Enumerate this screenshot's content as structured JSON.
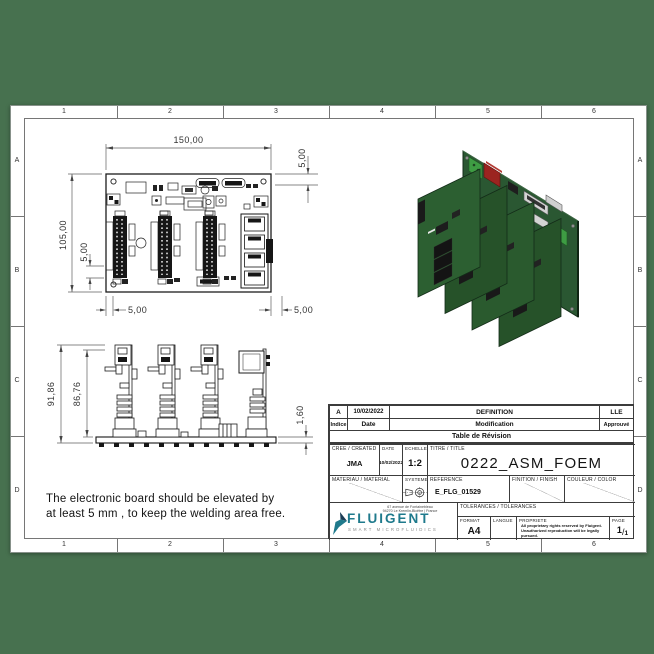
{
  "colors": {
    "background_green": "#47714F",
    "pcb_green": "#2A5732",
    "component_red": "#9B2420",
    "terminal_green": "#3E9C43",
    "logo_teal": "#1F7A8C",
    "logo_navy": "#1B3C55",
    "tagline_grey": "#8A8A8A"
  },
  "border": {
    "columns": [
      "1",
      "2",
      "3",
      "4",
      "5",
      "6"
    ],
    "rows": [
      "A",
      "B",
      "C",
      "D"
    ]
  },
  "views": {
    "top": {
      "width": "150,00",
      "height": "105,00",
      "margin_top": "5,00",
      "margin_left": "5,00",
      "margin_bottom_left": "5,00",
      "margin_bottom_right": "5,00"
    },
    "front": {
      "total_height": "91,86",
      "card_height": "86,76",
      "board_thickness": "1,60"
    }
  },
  "note": {
    "line1": "The electronic board should be elevated by",
    "line2": "at least 5 mm , to keep the welding area free."
  },
  "revision": {
    "row": {
      "indice": "A",
      "date": "10/02/2022",
      "modification": "DEFINITION",
      "approuve": "LLE"
    },
    "headers": {
      "indice": "Indice",
      "date": "Date",
      "modification": "Modification",
      "approuve": "Approuvé"
    },
    "caption": "Table de Révision"
  },
  "titleblock": {
    "cree_label": "CREE / CREATED",
    "cree_value": "JMA",
    "date_label": "DATE",
    "date_value": "10/02/2022",
    "echelle_label": "ECHELLE",
    "echelle_value": "1:2",
    "titre_label": "TITRE / TITLE",
    "titre_value": "0222_ASM_FOEM",
    "materiau_label": "MATERIAU / MATERIAL",
    "systeme_label": "SYSTEME",
    "reference_label": "REFERENCE",
    "reference_value": "E_FLG_01529",
    "finition_label": "FINITION / FINISH",
    "couleur_label": "COULEUR / COLOR",
    "tolerances_label": "TOLERANCES / TOLERANCES",
    "format_label": "FORMAT",
    "format_value": "A4",
    "langue_label": "LANGUE",
    "propriete_label": "PROPRIETE",
    "propriete_line1": "All proprietary rights reserved by Fluigent.",
    "propriete_line2": "Unauthorized reproduction will be legally pursued.",
    "page_label": "PAGE",
    "page_num": "1",
    "page_sep": "/",
    "page_total": "1",
    "address_line1": "67 avenue de Fontainebleau",
    "address_line2": "94270 Le Kremlin-Bicêtre | France",
    "logo_text": "FLUIGENT",
    "logo_tagline": "SMART MICROFLUIDICS"
  }
}
